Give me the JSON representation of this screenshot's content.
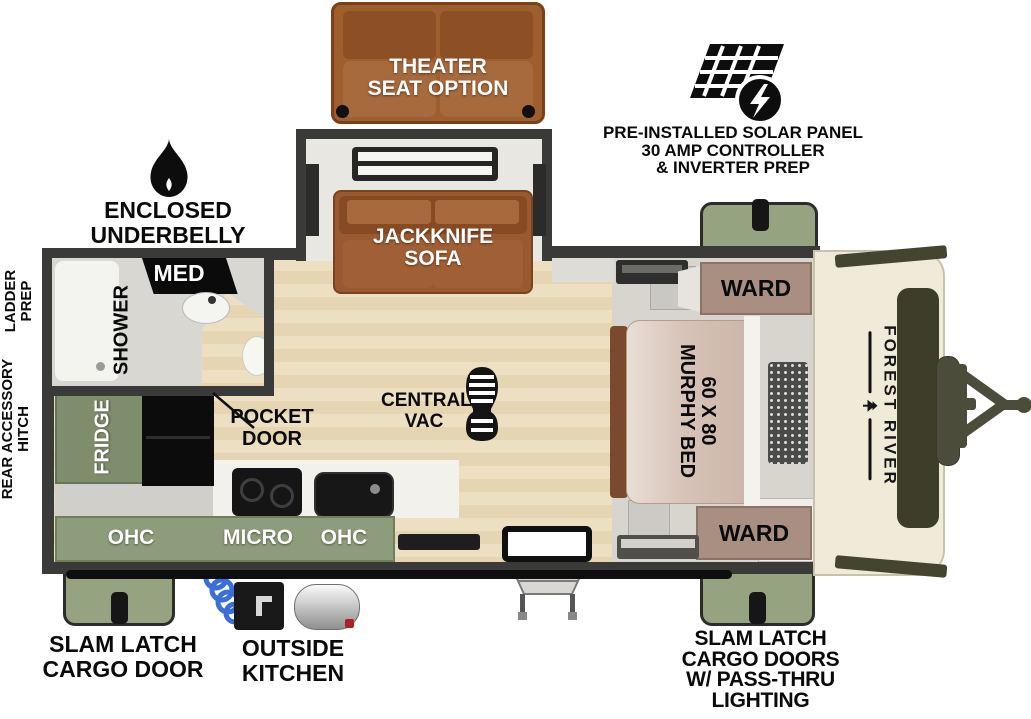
{
  "brand_logo": "FOREST RIVER",
  "labels": {
    "theater": [
      "THEATER",
      "SEAT OPTION"
    ],
    "jackknife": [
      "JACKKNIFE",
      "SOFA"
    ],
    "solar": [
      "PRE-INSTALLED SOLAR PANEL",
      "30 AMP CONTROLLER",
      "& INVERTER PREP"
    ],
    "underbelly": [
      "ENCLOSED UNDERBELLY",
      "W/ FORCED HEAT"
    ],
    "ladder_prep": [
      "LADDER",
      "PREP"
    ],
    "rear_accessory_hitch": [
      "REAR ACCESSORY",
      "HITCH"
    ],
    "shower": "SHOWER",
    "med": "MED",
    "pocket_door": [
      "POCKET",
      "DOOR"
    ],
    "fridge": "FRIDGE",
    "ohc_left": "OHC",
    "micro": "MICRO",
    "ohc_right": "OHC",
    "central_vac": [
      "CENTRAL",
      "VAC"
    ],
    "ward_top": "WARD",
    "ward_bottom": "WARD",
    "murphy_bed": [
      "60 X 80",
      "MURPHY BED"
    ],
    "slam_latch_left": [
      "SLAM LATCH",
      "CARGO DOOR"
    ],
    "outside_kitchen": [
      "OUTSIDE",
      "KITCHEN"
    ],
    "slam_latch_right": [
      "SLAM LATCH",
      "CARGO DOORS",
      "W/ PASS-THRU",
      "LIGHTING"
    ]
  },
  "colors": {
    "wall": "#3a3a38",
    "floor_beige": "#ead9b8",
    "sofa_brown": "#9a5a30",
    "sage_green": "#95a381",
    "fridge_green": "#7e8e6d",
    "ward_mauve": "#a98f82",
    "bed_mauve": "#d2beb3",
    "cap_ivory": "#efe9d7",
    "olive": "#4a4a36",
    "hose_blue": "#3a6fd8"
  }
}
